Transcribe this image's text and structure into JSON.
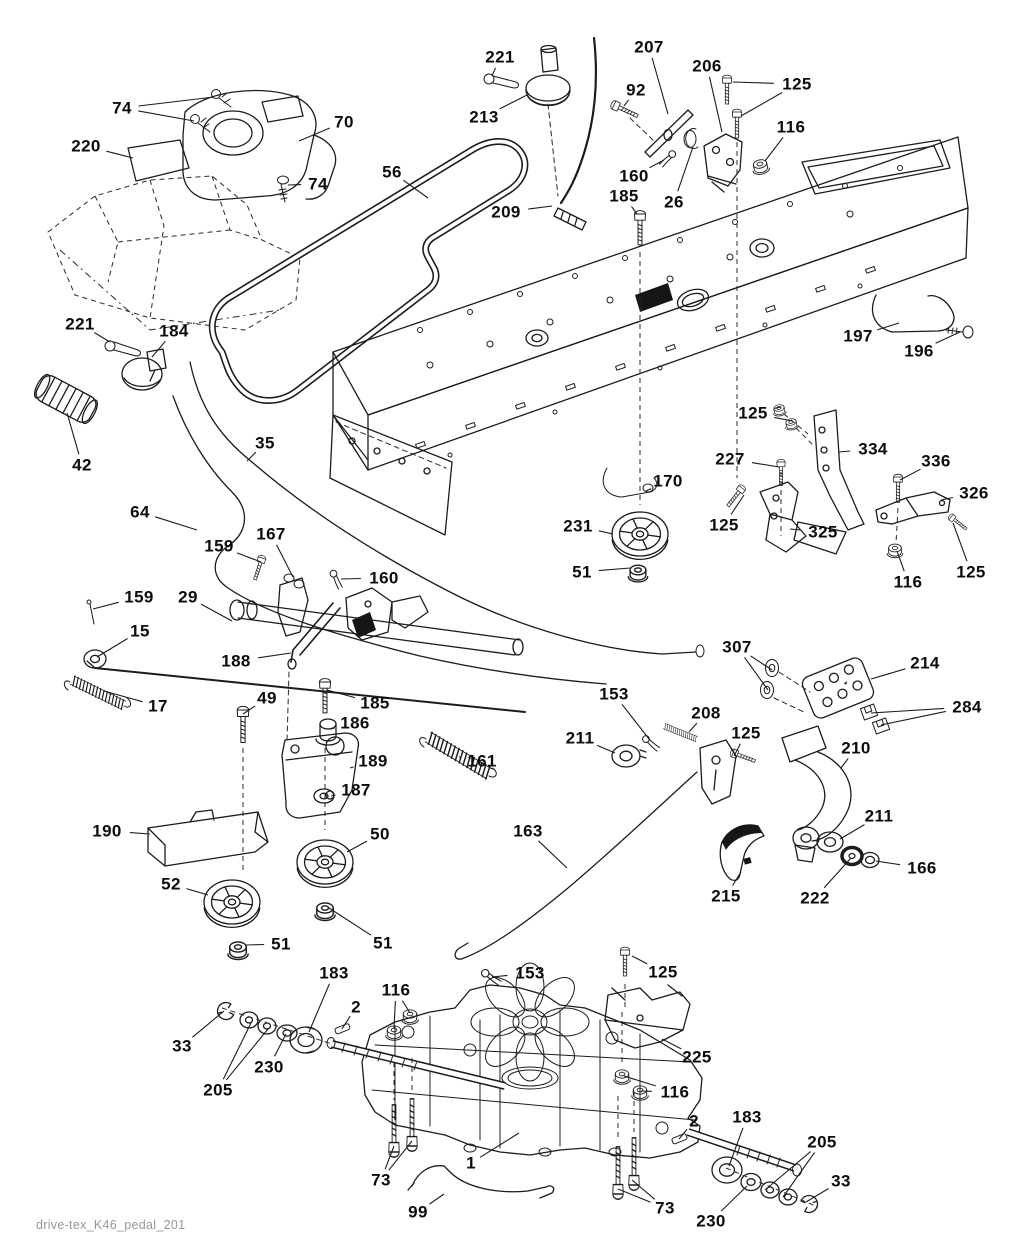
{
  "document": {
    "caption": "drive-tex_K46_pedal_201",
    "background_color": "#ffffff",
    "line_color": "#1c1c1c",
    "label_color": "#0c0c0c",
    "caption_color": "#979797"
  },
  "diagram": {
    "type": "exploded-parts-diagram",
    "labels": [
      {
        "text": "74",
        "x": 122,
        "y": 108,
        "to": [
          [
            214,
            97
          ],
          [
            194,
            121
          ]
        ]
      },
      {
        "text": "70",
        "x": 344,
        "y": 122,
        "to": [
          [
            299,
            141
          ]
        ]
      },
      {
        "text": "220",
        "x": 86,
        "y": 146,
        "to": [
          [
            133,
            158
          ]
        ]
      },
      {
        "text": "74",
        "x": 318,
        "y": 184,
        "to": [
          [
            288,
            185
          ]
        ]
      },
      {
        "text": "56",
        "x": 392,
        "y": 172,
        "to": [
          [
            428,
            198
          ]
        ]
      },
      {
        "text": "221",
        "x": 500,
        "y": 57,
        "to": [
          [
            492,
            76
          ]
        ]
      },
      {
        "text": "213",
        "x": 484,
        "y": 117,
        "to": [
          [
            527,
            95
          ]
        ]
      },
      {
        "text": "207",
        "x": 649,
        "y": 47,
        "to": [
          [
            668,
            114
          ]
        ]
      },
      {
        "text": "206",
        "x": 707,
        "y": 66,
        "to": [
          [
            722,
            132
          ]
        ]
      },
      {
        "text": "92",
        "x": 636,
        "y": 90,
        "to": [
          [
            624,
            106
          ]
        ]
      },
      {
        "text": "125",
        "x": 797,
        "y": 84,
        "to": [
          [
            733,
            82
          ],
          [
            741,
            116
          ]
        ]
      },
      {
        "text": "116",
        "x": 791,
        "y": 127,
        "to": [
          [
            765,
            161
          ]
        ]
      },
      {
        "text": "160",
        "x": 634,
        "y": 176,
        "to": [
          [
            664,
            160
          ]
        ]
      },
      {
        "text": "185",
        "x": 624,
        "y": 196,
        "to": [
          [
            637,
            214
          ]
        ]
      },
      {
        "text": "26",
        "x": 674,
        "y": 202,
        "to": [
          [
            693,
            147
          ]
        ]
      },
      {
        "text": "209",
        "x": 506,
        "y": 212,
        "to": [
          [
            552,
            206
          ]
        ]
      },
      {
        "text": "197",
        "x": 858,
        "y": 336,
        "to": [
          [
            899,
            323
          ]
        ]
      },
      {
        "text": "196",
        "x": 919,
        "y": 351,
        "to": [
          [
            960,
            332
          ]
        ]
      },
      {
        "text": "221",
        "x": 80,
        "y": 324,
        "to": [
          [
            110,
            342
          ]
        ]
      },
      {
        "text": "184",
        "x": 174,
        "y": 331,
        "to": [
          [
            152,
            357
          ]
        ]
      },
      {
        "text": "42",
        "x": 82,
        "y": 465,
        "to": [
          [
            67,
            413
          ]
        ]
      },
      {
        "text": "35",
        "x": 265,
        "y": 443,
        "to": [
          [
            247,
            461
          ]
        ]
      },
      {
        "text": "64",
        "x": 140,
        "y": 512,
        "to": [
          [
            197,
            530
          ]
        ]
      },
      {
        "text": "159",
        "x": 219,
        "y": 546,
        "to": [
          [
            261,
            562
          ]
        ]
      },
      {
        "text": "167",
        "x": 271,
        "y": 534,
        "to": [
          [
            293,
            577
          ]
        ]
      },
      {
        "text": "160",
        "x": 384,
        "y": 578,
        "to": [
          [
            341,
            579
          ]
        ]
      },
      {
        "text": "159",
        "x": 139,
        "y": 597,
        "to": [
          [
            93,
            609
          ]
        ]
      },
      {
        "text": "29",
        "x": 188,
        "y": 597,
        "to": [
          [
            232,
            621
          ]
        ]
      },
      {
        "text": "15",
        "x": 140,
        "y": 631,
        "to": [
          [
            97,
            657
          ]
        ]
      },
      {
        "text": "188",
        "x": 236,
        "y": 661,
        "to": [
          [
            291,
            653
          ]
        ]
      },
      {
        "text": "17",
        "x": 158,
        "y": 706,
        "to": [
          [
            104,
            691
          ]
        ]
      },
      {
        "text": "170",
        "x": 668,
        "y": 481,
        "to": [
          [
            646,
            491
          ]
        ]
      },
      {
        "text": "231",
        "x": 578,
        "y": 526,
        "to": [
          [
            613,
            534
          ]
        ]
      },
      {
        "text": "51",
        "x": 582,
        "y": 572,
        "to": [
          [
            630,
            568
          ]
        ]
      },
      {
        "text": "227",
        "x": 730,
        "y": 459,
        "to": [
          [
            779,
            467
          ]
        ]
      },
      {
        "text": "125",
        "x": 753,
        "y": 413,
        "to": [
          [
            781,
            407
          ],
          [
            792,
            421
          ]
        ]
      },
      {
        "text": "334",
        "x": 873,
        "y": 449,
        "to": [
          [
            839,
            452
          ]
        ]
      },
      {
        "text": "336",
        "x": 936,
        "y": 461,
        "to": [
          [
            900,
            480
          ]
        ]
      },
      {
        "text": "326",
        "x": 974,
        "y": 493,
        "to": [
          [
            941,
            500
          ]
        ]
      },
      {
        "text": "125",
        "x": 724,
        "y": 525,
        "to": [
          [
            744,
            495
          ]
        ]
      },
      {
        "text": "325",
        "x": 823,
        "y": 532,
        "to": [
          [
            790,
            529
          ]
        ]
      },
      {
        "text": "116",
        "x": 908,
        "y": 582,
        "to": [
          [
            897,
            551
          ]
        ]
      },
      {
        "text": "125",
        "x": 971,
        "y": 572,
        "to": [
          [
            953,
            523
          ]
        ]
      },
      {
        "text": "49",
        "x": 267,
        "y": 698,
        "to": [
          [
            243,
            714
          ]
        ]
      },
      {
        "text": "185",
        "x": 375,
        "y": 703,
        "to": [
          [
            327,
            690
          ]
        ]
      },
      {
        "text": "186",
        "x": 355,
        "y": 723,
        "to": [
          [
            331,
            729
          ]
        ]
      },
      {
        "text": "189",
        "x": 373,
        "y": 761,
        "to": [
          [
            350,
            768
          ]
        ]
      },
      {
        "text": "161",
        "x": 482,
        "y": 761,
        "to": [
          [
            459,
            757
          ]
        ]
      },
      {
        "text": "187",
        "x": 356,
        "y": 790,
        "to": [
          [
            331,
            796
          ]
        ]
      },
      {
        "text": "190",
        "x": 107,
        "y": 831,
        "to": [
          [
            150,
            834
          ]
        ]
      },
      {
        "text": "50",
        "x": 380,
        "y": 834,
        "to": [
          [
            347,
            852
          ]
        ]
      },
      {
        "text": "52",
        "x": 171,
        "y": 884,
        "to": [
          [
            208,
            895
          ]
        ]
      },
      {
        "text": "51",
        "x": 281,
        "y": 944,
        "to": [
          [
            246,
            945
          ]
        ]
      },
      {
        "text": "51",
        "x": 383,
        "y": 943,
        "to": [
          [
            329,
            908
          ]
        ]
      },
      {
        "text": "153",
        "x": 614,
        "y": 694,
        "to": [
          [
            649,
            739
          ]
        ]
      },
      {
        "text": "208",
        "x": 706,
        "y": 713,
        "to": [
          [
            689,
            732
          ]
        ]
      },
      {
        "text": "211",
        "x": 580,
        "y": 738,
        "to": [
          [
            615,
            753
          ]
        ]
      },
      {
        "text": "125",
        "x": 746,
        "y": 733,
        "to": [
          [
            734,
            756
          ]
        ]
      },
      {
        "text": "210",
        "x": 856,
        "y": 748,
        "to": [
          [
            841,
            768
          ]
        ]
      },
      {
        "text": "307",
        "x": 737,
        "y": 647,
        "to": [
          [
            772,
            670
          ],
          [
            768,
            690
          ]
        ]
      },
      {
        "text": "214",
        "x": 925,
        "y": 663,
        "to": [
          [
            871,
            679
          ]
        ]
      },
      {
        "text": "284",
        "x": 967,
        "y": 707,
        "to": [
          [
            871,
            713
          ],
          [
            881,
            725
          ]
        ]
      },
      {
        "text": "211",
        "x": 879,
        "y": 816,
        "to": [
          [
            840,
            839
          ]
        ]
      },
      {
        "text": "166",
        "x": 922,
        "y": 868,
        "to": [
          [
            876,
            861
          ]
        ]
      },
      {
        "text": "222",
        "x": 815,
        "y": 898,
        "to": [
          [
            851,
            858
          ]
        ]
      },
      {
        "text": "215",
        "x": 726,
        "y": 896,
        "to": [
          [
            741,
            872
          ]
        ]
      },
      {
        "text": "163",
        "x": 528,
        "y": 831,
        "to": [
          [
            567,
            868
          ]
        ]
      },
      {
        "text": "183",
        "x": 334,
        "y": 973,
        "to": [
          [
            309,
            1032
          ]
        ]
      },
      {
        "text": "2",
        "x": 356,
        "y": 1007,
        "to": [
          [
            342,
            1029
          ]
        ]
      },
      {
        "text": "116",
        "x": 396,
        "y": 990,
        "to": [
          [
            394,
            1028
          ],
          [
            410,
            1013
          ]
        ]
      },
      {
        "text": "33",
        "x": 182,
        "y": 1046,
        "to": [
          [
            224,
            1011
          ]
        ]
      },
      {
        "text": "205",
        "x": 218,
        "y": 1090,
        "to": [
          [
            251,
            1023
          ],
          [
            268,
            1029
          ]
        ]
      },
      {
        "text": "230",
        "x": 269,
        "y": 1067,
        "to": [
          [
            286,
            1034
          ]
        ]
      },
      {
        "text": "153",
        "x": 530,
        "y": 973,
        "to": [
          [
            492,
            977
          ]
        ]
      },
      {
        "text": "125",
        "x": 663,
        "y": 972,
        "to": [
          [
            632,
            956
          ]
        ]
      },
      {
        "text": "225",
        "x": 697,
        "y": 1057,
        "to": [
          [
            662,
            1039
          ]
        ]
      },
      {
        "text": "116",
        "x": 675,
        "y": 1092,
        "to": [
          [
            641,
            1091
          ],
          [
            624,
            1076
          ]
        ]
      },
      {
        "text": "2",
        "x": 694,
        "y": 1121,
        "to": [
          [
            679,
            1139
          ]
        ]
      },
      {
        "text": "183",
        "x": 747,
        "y": 1117,
        "to": [
          [
            729,
            1166
          ]
        ]
      },
      {
        "text": "205",
        "x": 822,
        "y": 1142,
        "to": [
          [
            765,
            1190
          ],
          [
            783,
            1197
          ]
        ]
      },
      {
        "text": "33",
        "x": 841,
        "y": 1181,
        "to": [
          [
            806,
            1202
          ]
        ]
      },
      {
        "text": "230",
        "x": 711,
        "y": 1221,
        "to": [
          [
            747,
            1186
          ]
        ]
      },
      {
        "text": "73",
        "x": 381,
        "y": 1180,
        "to": [
          [
            394,
            1146
          ],
          [
            412,
            1141
          ]
        ]
      },
      {
        "text": "99",
        "x": 418,
        "y": 1212,
        "to": [
          [
            444,
            1194
          ]
        ]
      },
      {
        "text": "1",
        "x": 471,
        "y": 1163,
        "to": [
          [
            519,
            1133
          ]
        ]
      },
      {
        "text": "73",
        "x": 665,
        "y": 1208,
        "to": [
          [
            618,
            1189
          ],
          [
            632,
            1180
          ]
        ]
      }
    ]
  }
}
